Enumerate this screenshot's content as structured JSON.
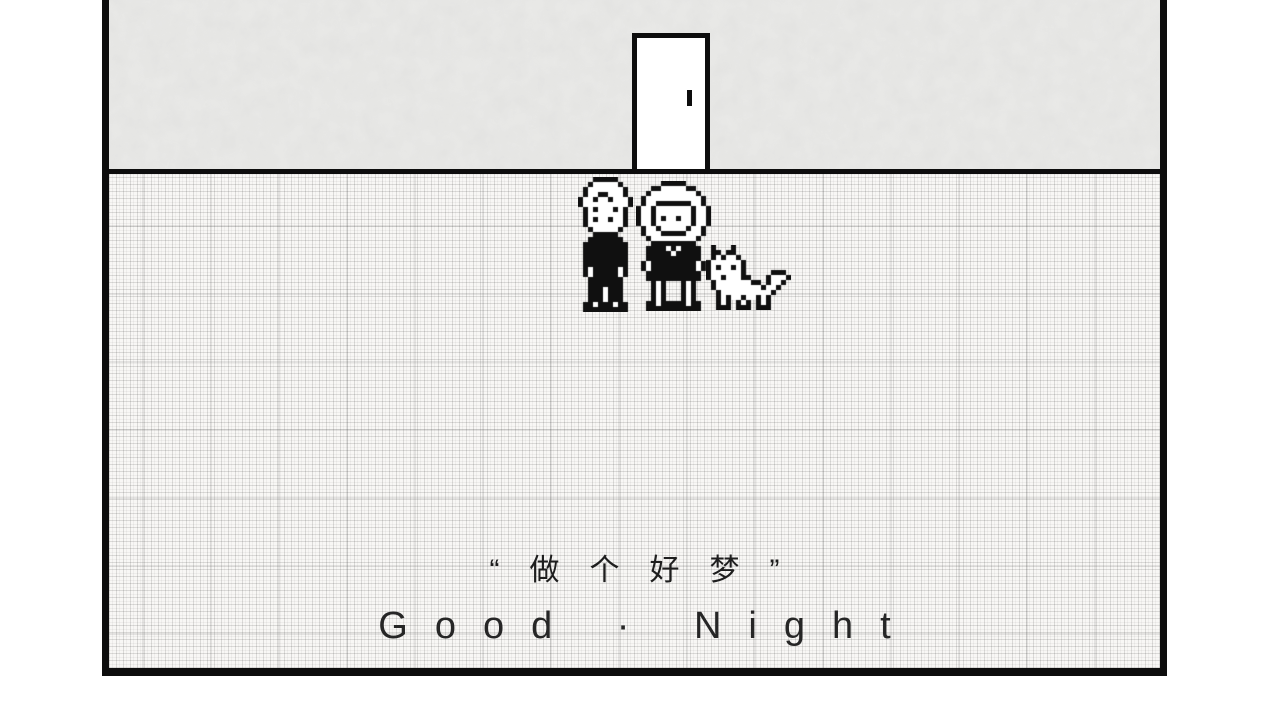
{
  "scene": {
    "description": "black-and-white pixel game scene: two children and a cat standing on a plaid floor in front of a closed door",
    "colors": {
      "page_background": "#ffffff",
      "frame_border": "#0d0d0d",
      "wall": "#eaeae8",
      "floor": "#f8f7f5",
      "door_fill": "#ffffff",
      "sprite_black": "#101010",
      "sprite_white": "#ffffff",
      "caption_text": "#1e1e1e"
    }
  },
  "captions": {
    "chinese": "“做个好梦”",
    "english": "Good · Night"
  },
  "sprites": {
    "boy": {
      "scale": 5,
      "palette": {
        "B": "#101010",
        "W": "#ffffff"
      },
      "rows": [
        "...BBBBB...",
        "..BWWWWWB..",
        ".BWWWWWWWB.",
        ".BWWBBWWWB.",
        "BWWBWWBWWWB",
        "BWWWWWWWWWB",
        ".BWBWWWBWB.",
        ".BWWWWWWWB.",
        ".BWBWWBWWB.",
        ".BWWWWWWWB.",
        "..BWWWWWB..",
        "...BBBBB...",
        "..BBBBBBB..",
        ".BBBBBBBBB.",
        ".BBBBBBBBB.",
        ".BBBBBBBBB.",
        ".BBBBBBBBB.",
        ".BBBBBBBBB.",
        ".BWBBBBBWB.",
        ".BWBBBBBWB.",
        "..BBBBBBB..",
        "..BBBBBBB..",
        "..BBBWBBB..",
        "..BBBWBBB..",
        "..BBBWBBB..",
        ".BBWBBBWBB.",
        ".BBBBBBBBB."
      ]
    },
    "girl": {
      "scale": 5,
      "palette": {
        "B": "#101010",
        "W": "#ffffff"
      },
      "rows": [
        ".....BBBBB.....",
        "...BBWWWWWBB...",
        "..BWWWWWWWWWB..",
        ".BWWWWWWWWWWWB.",
        ".BWWBBBBBBBWWB.",
        "BWWBWWWWWWWBWWB",
        "BWWBWWWWWWWBWWB",
        "BWWBWBWWBWWBWWB",
        "BWWBWWWWWWWBWWB",
        ".BWWBWWWWWBWWB.",
        ".BWWWBBBBBWWWB.",
        "..BWWWWWWWWWB..",
        "...BBBBBBBBB...",
        "..BBBBWBWBBBB..",
        "..BBBBBWBBBBB..",
        "..BBBBBBBBBBB..",
        ".BWBBBBBBBBBWB.",
        ".BWBBBBBBBBBWB.",
        "..BBBBBBBBBBB..",
        "..BBBBBBBBBBB..",
        "...BWB...BWB...",
        "...BWB...BWB...",
        "...BWB...BWB...",
        "...BWB...BWB...",
        "..BBWBBBBBWBB..",
        "..BBBBBBBBBBB.."
      ]
    },
    "cat": {
      "scale": 5,
      "palette": {
        "B": "#101010",
        "W": "#ffffff"
      },
      "rows": [
        ".B...B...........",
        ".BB.BB...........",
        ".BWBWWB..........",
        "BWWWWWWB.........",
        "BWBWWBWB.........",
        "BWWWWWWB.....BBB.",
        "BWWBWWWBB...BWWWB",
        ".BWWWWWWWBB.BWWB.",
        ".BWWWWWWWWWBWWB..",
        "..BWWWWWWWWWWB...",
        "..BWBWWBWWBWB....",
        "..BWB.BWB.BWB....",
        "..BBB.BBB.BBB...."
      ]
    }
  }
}
